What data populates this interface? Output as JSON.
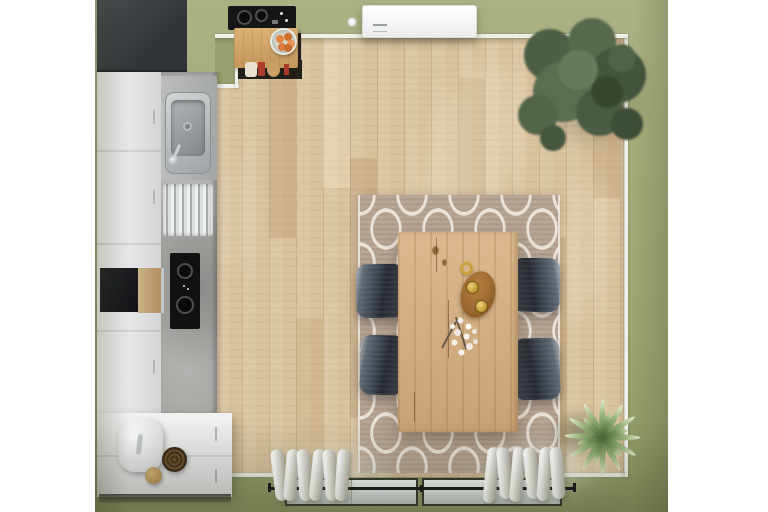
{
  "meta": {
    "title": "Top-down 3D interior render of a kitchen and dining room",
    "view": "bird's-eye overhead",
    "style": "photorealistic render on white background"
  },
  "palette": {
    "background": "#ffffff",
    "wall_green": "#9aa372",
    "floor_wood": "#d9c29e",
    "baseboard": "#eff0e9",
    "rug_base": "#b2a08f",
    "rug_pattern": "#eae3d9",
    "table_oak": "#d6ae7c",
    "chair_slate": "#39414c",
    "cabinet_white": "#eceded",
    "counter_concrete": "#a7a7a4",
    "appliance_black": "#121212",
    "bar_wood": "#d0a468",
    "orange_fruit": "#dd8040",
    "tree_green": "#55684d",
    "plant_green": "#95b078",
    "curtain_white": "#f4f3f0",
    "window_frame": "#33362f",
    "basket_brown": "#5d4428"
  },
  "objects": {
    "room": {
      "label": "Kitchen-dining room seen from directly above"
    },
    "kitchen": {
      "label": "Kitchen run along the left wall",
      "tall_dark_cabinet": "Dark tall cabinet block",
      "white_cabinets": "White cabinet fronts",
      "concrete_counter": "Concrete-look countertop",
      "sink": "Stainless steel sink",
      "faucet": "Chrome faucet",
      "dish_rack": "Dish drying rack",
      "induction_cooktop": "Black induction cooktop with two burners",
      "dark_appliance": "Built-in dark appliance",
      "wood_board": "Wooden board with steel trim",
      "base_cabinet": "White base cabinet",
      "bread_bin": "White oval bread bin",
      "wicker_basket": "Round wicker basket",
      "jute_ball": "Small jute ball"
    },
    "bar": {
      "label": "Top-wall corner with gas hob and bar table",
      "gas_hob": "Black gas hob with two burners",
      "bar_table": "Small wooden bar table",
      "stools": "Bar stools tucked underneath",
      "fruit_bowl": "Glass bowl of oranges"
    },
    "dining": {
      "label": "Dining area on trellis rug",
      "rug": "Taupe rug with white quatrefoil trellis pattern",
      "table": "Rectangular oak dining table",
      "chair": "Dark slate upholstered chair",
      "cup": "Gold cup ring",
      "candle_board": "Oval wooden board with two gold candles",
      "flowers": "Sprig of white blossoms"
    },
    "decor": {
      "tree": "Large potted olive tree in top-right corner",
      "spiky_plant": "Spiky green plant in bottom-right corner",
      "wall_unit": "White wall-mounted unit on top wall",
      "ceiling_spot": "Round ceiling spotlight"
    },
    "window": {
      "label": "Bottom wall window with sheer curtains",
      "glass": "Window glass panes",
      "rod": "Dark curtain rod",
      "curtain_left": "Gathered white curtain, left",
      "curtain_right": "Gathered white curtain, right"
    }
  }
}
